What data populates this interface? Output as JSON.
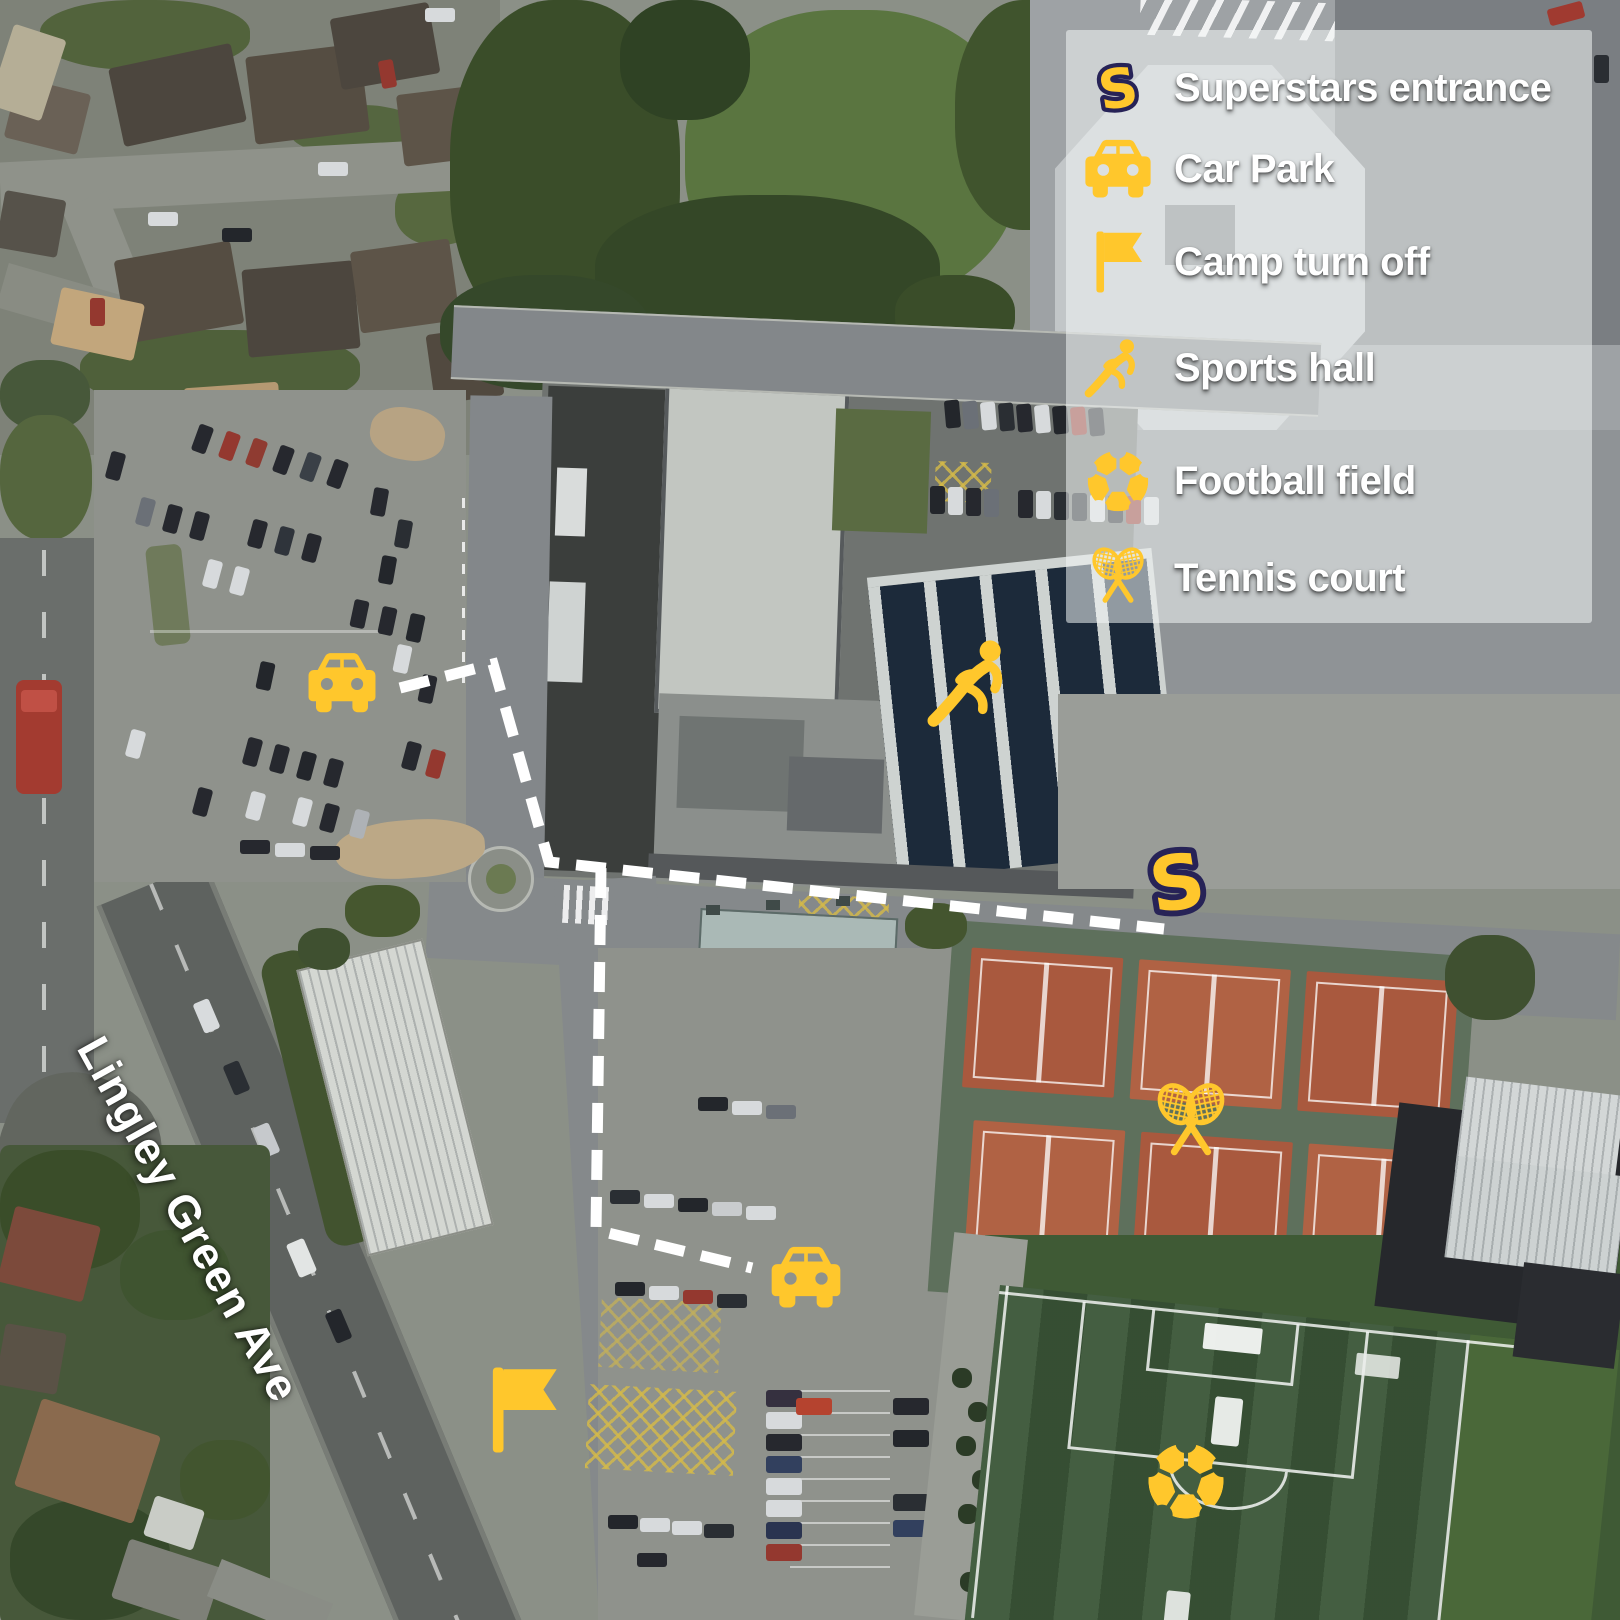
{
  "legend": {
    "items": [
      {
        "icon": "s",
        "icon_name": "superstars-s-icon",
        "label": "Superstars entrance"
      },
      {
        "icon": "car",
        "icon_name": "car-icon",
        "label": "Car Park"
      },
      {
        "icon": "flag",
        "icon_name": "flag-icon",
        "label": "Camp turn off"
      },
      {
        "icon": "runner",
        "icon_name": "runner-icon",
        "label": "Sports hall"
      },
      {
        "icon": "football",
        "icon_name": "football-icon",
        "label": "Football field"
      },
      {
        "icon": "tennis",
        "icon_name": "tennis-rackets-icon",
        "label": "Tennis court"
      }
    ]
  },
  "map": {
    "road_label": "Lingley Green Ave",
    "route": {
      "d1": "M400,688 L493,664 L549,862 L1164,929",
      "d2": "M601,868 L596,1230 L752,1268",
      "dash_pattern": "30 17",
      "stroke_width": 11
    },
    "markers": [
      {
        "name": "car-park-north-marker",
        "icon": "car",
        "x": 303,
        "y": 650,
        "w": 78,
        "h": 66
      },
      {
        "name": "car-park-south-marker",
        "icon": "car",
        "x": 766,
        "y": 1244,
        "w": 80,
        "h": 67
      },
      {
        "name": "superstars-entrance-marker",
        "icon": "s",
        "x": 1138,
        "y": 836,
        "w": 78,
        "h": 92
      },
      {
        "name": "sports-hall-marker",
        "icon": "runner",
        "x": 924,
        "y": 634,
        "w": 106,
        "h": 98
      },
      {
        "name": "tennis-court-marker",
        "icon": "tennis",
        "x": 1141,
        "y": 1080,
        "w": 100,
        "h": 86
      },
      {
        "name": "football-field-marker",
        "icon": "football",
        "x": 1145,
        "y": 1440,
        "w": 82,
        "h": 82
      },
      {
        "name": "camp-turn-off-marker",
        "icon": "flag",
        "x": 484,
        "y": 1362,
        "w": 78,
        "h": 96
      }
    ]
  },
  "colors": {
    "accent_yellow": "#FFC72C",
    "navy_outline": "#272357",
    "route_white": "#FFFFFF",
    "legend_panel": "rgba(243,245,246,0.55)",
    "tennis_court_orange": "#A9593E",
    "pitch_green": "#3A5537"
  }
}
